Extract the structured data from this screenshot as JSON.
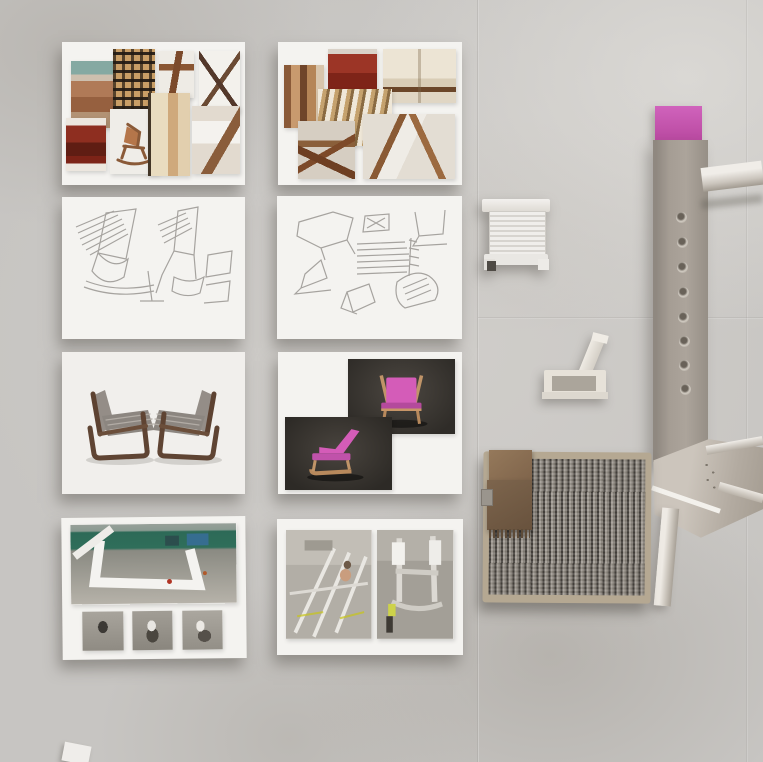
{
  "scene": {
    "title": "Chair design process — top-down studio photo on concrete",
    "background_color": "#c7c5c2",
    "accent_pink": "#c95ab4",
    "wood_brown": "#8a5a38",
    "metal_gray": "#a49d94",
    "fabric_gray": "#847e76",
    "leather_brown": "#7d654d",
    "paper_white": "#f4f3f0"
  },
  "boards": [
    {
      "id": "moodboard-left",
      "label": "Mood board — wooden lounge chair reference photos",
      "type": "photo-collage"
    },
    {
      "id": "moodboard-right",
      "label": "Mood board — woven and upholstered chair references",
      "type": "photo-collage"
    },
    {
      "id": "sketches-left",
      "label": "Pencil sketches — lounge chair concept studies",
      "type": "sketch"
    },
    {
      "id": "sketches-right",
      "label": "Pencil sketches — frame and weave detail studies",
      "type": "sketch"
    },
    {
      "id": "render-pair",
      "label": "3D render — two woven-seat wooden chairs facing each other",
      "type": "render"
    },
    {
      "id": "render-pink",
      "label": "3D renders — pink chair, front and side views on dark background",
      "type": "render"
    },
    {
      "id": "workshop-left",
      "label": "Workshop photos — white chair frame under green canopy plus three test shots",
      "type": "photo"
    },
    {
      "id": "workshop-right",
      "label": "Workshop photos — metal chair frame fabrication",
      "type": "photo"
    }
  ],
  "objects": [
    {
      "id": "printed-model",
      "label": "White ribbed 3D-printed chair scale model, top view"
    },
    {
      "id": "foam-maquette",
      "label": "Cream foam chair maquette, side view"
    },
    {
      "id": "metal-prototype",
      "label": "Full-size brushed metal chair prototype with drilled backrest and pink top pad"
    },
    {
      "id": "fabric-sample",
      "label": "Ribbed grey tweed upholstery sample with brown leather swatches and clip"
    }
  ]
}
